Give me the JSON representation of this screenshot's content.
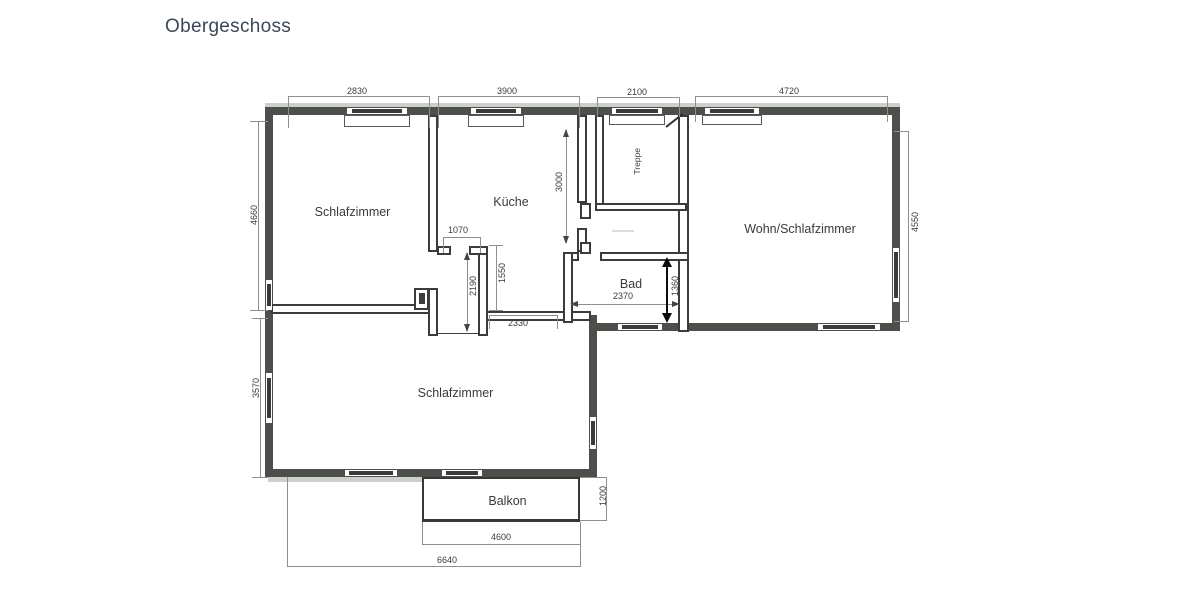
{
  "title": "Obergeschoss",
  "rooms": {
    "bedroom_top": "Schlafzimmer",
    "kitchen": "Küche",
    "stairs": "Treppe",
    "living_bedroom": "Wohn/Schlafzimmer",
    "bath": "Bad",
    "bedroom_bottom": "Schlafzimmer",
    "balcony": "Balkon"
  },
  "dimensions": {
    "top_bedroom_width": "2830",
    "kitchen_width": "3900",
    "stairs_width": "2100",
    "living_width": "4720",
    "left_upper_height": "4660",
    "left_lower_height": "3570",
    "right_height": "4550",
    "kitchen_depth": "3000",
    "niche_width": "1070",
    "corridor_height": "2190",
    "passage_height": "1550",
    "corridor_width": "2330",
    "bath_width": "2370",
    "bath_height": "1360",
    "balcony_depth": "1200",
    "balcony_width": "4600",
    "bottom_total_width": "6640"
  },
  "colors": {
    "wall": "#4c4f4a",
    "line": "#3c3c3c",
    "dim_line": "#8f8f8f",
    "title_text": "#3b4856"
  }
}
